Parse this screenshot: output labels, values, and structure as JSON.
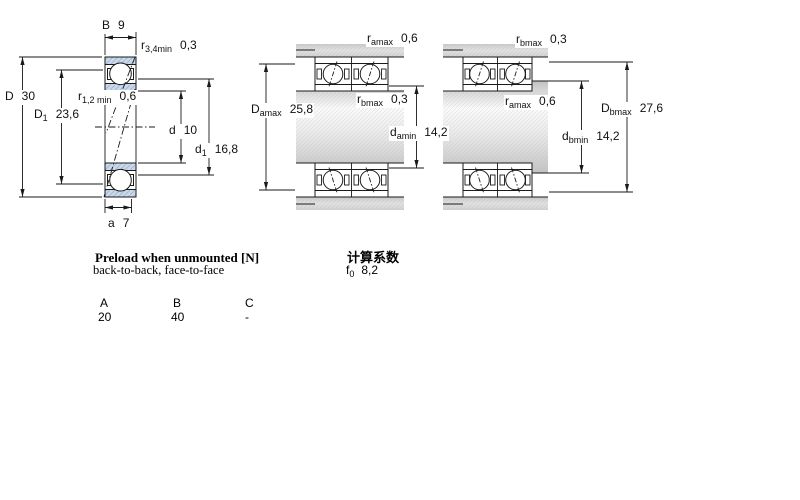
{
  "page": {
    "background": "#ffffff"
  },
  "colors": {
    "line": "#1a1a1a",
    "ring_fill": "#cbd9ea",
    "ring_hatch": "#a4b8d4",
    "metal_gray": "#d8d8d8",
    "shaft_highlight": "#fbfbfb"
  },
  "left_diagram": {
    "dims": {
      "B": {
        "base": "B",
        "value": "9"
      },
      "r34": {
        "base": "r",
        "sub": "3,4min",
        "value": "0,3"
      },
      "D": {
        "base": "D",
        "value": "30"
      },
      "D1": {
        "base": "D",
        "sub": "1",
        "value": "23,6"
      },
      "r12": {
        "base": "r",
        "sub": "1,2 min",
        "value": "0,6"
      },
      "d": {
        "base": "d",
        "value": "10"
      },
      "d1": {
        "base": "d",
        "sub": "1",
        "value": "16,8"
      },
      "a": {
        "base": "a",
        "value": "7"
      }
    }
  },
  "middle_diagram": {
    "dims": {
      "ramax": {
        "base": "r",
        "sub": "amax",
        "value": "0,6"
      },
      "rbmax": {
        "base": "r",
        "sub": "bmax",
        "value": "0,3"
      },
      "Damax": {
        "base": "D",
        "sub": "amax",
        "value": "25,8"
      },
      "damin": {
        "base": "d",
        "sub": "amin",
        "value": "14,2"
      }
    }
  },
  "right_diagram": {
    "dims": {
      "rbmax": {
        "base": "r",
        "sub": "bmax",
        "value": "0,3"
      },
      "ramax": {
        "base": "r",
        "sub": "amax",
        "value": "0,6"
      },
      "Dbmax": {
        "base": "D",
        "sub": "bmax",
        "value": "27,6"
      },
      "dbmin": {
        "base": "d",
        "sub": "bmin",
        "value": "14,2"
      }
    }
  },
  "preload_section": {
    "title": "Preload when unmounted [N]",
    "subtitle": "back-to-back, face-to-face",
    "table": {
      "headers": [
        "A",
        "B",
        "C"
      ],
      "values": [
        "20",
        "40",
        "-"
      ]
    }
  },
  "calc_section": {
    "title": "计算系数",
    "f0": {
      "base": "f",
      "sub": "0",
      "value": "8,2"
    }
  }
}
